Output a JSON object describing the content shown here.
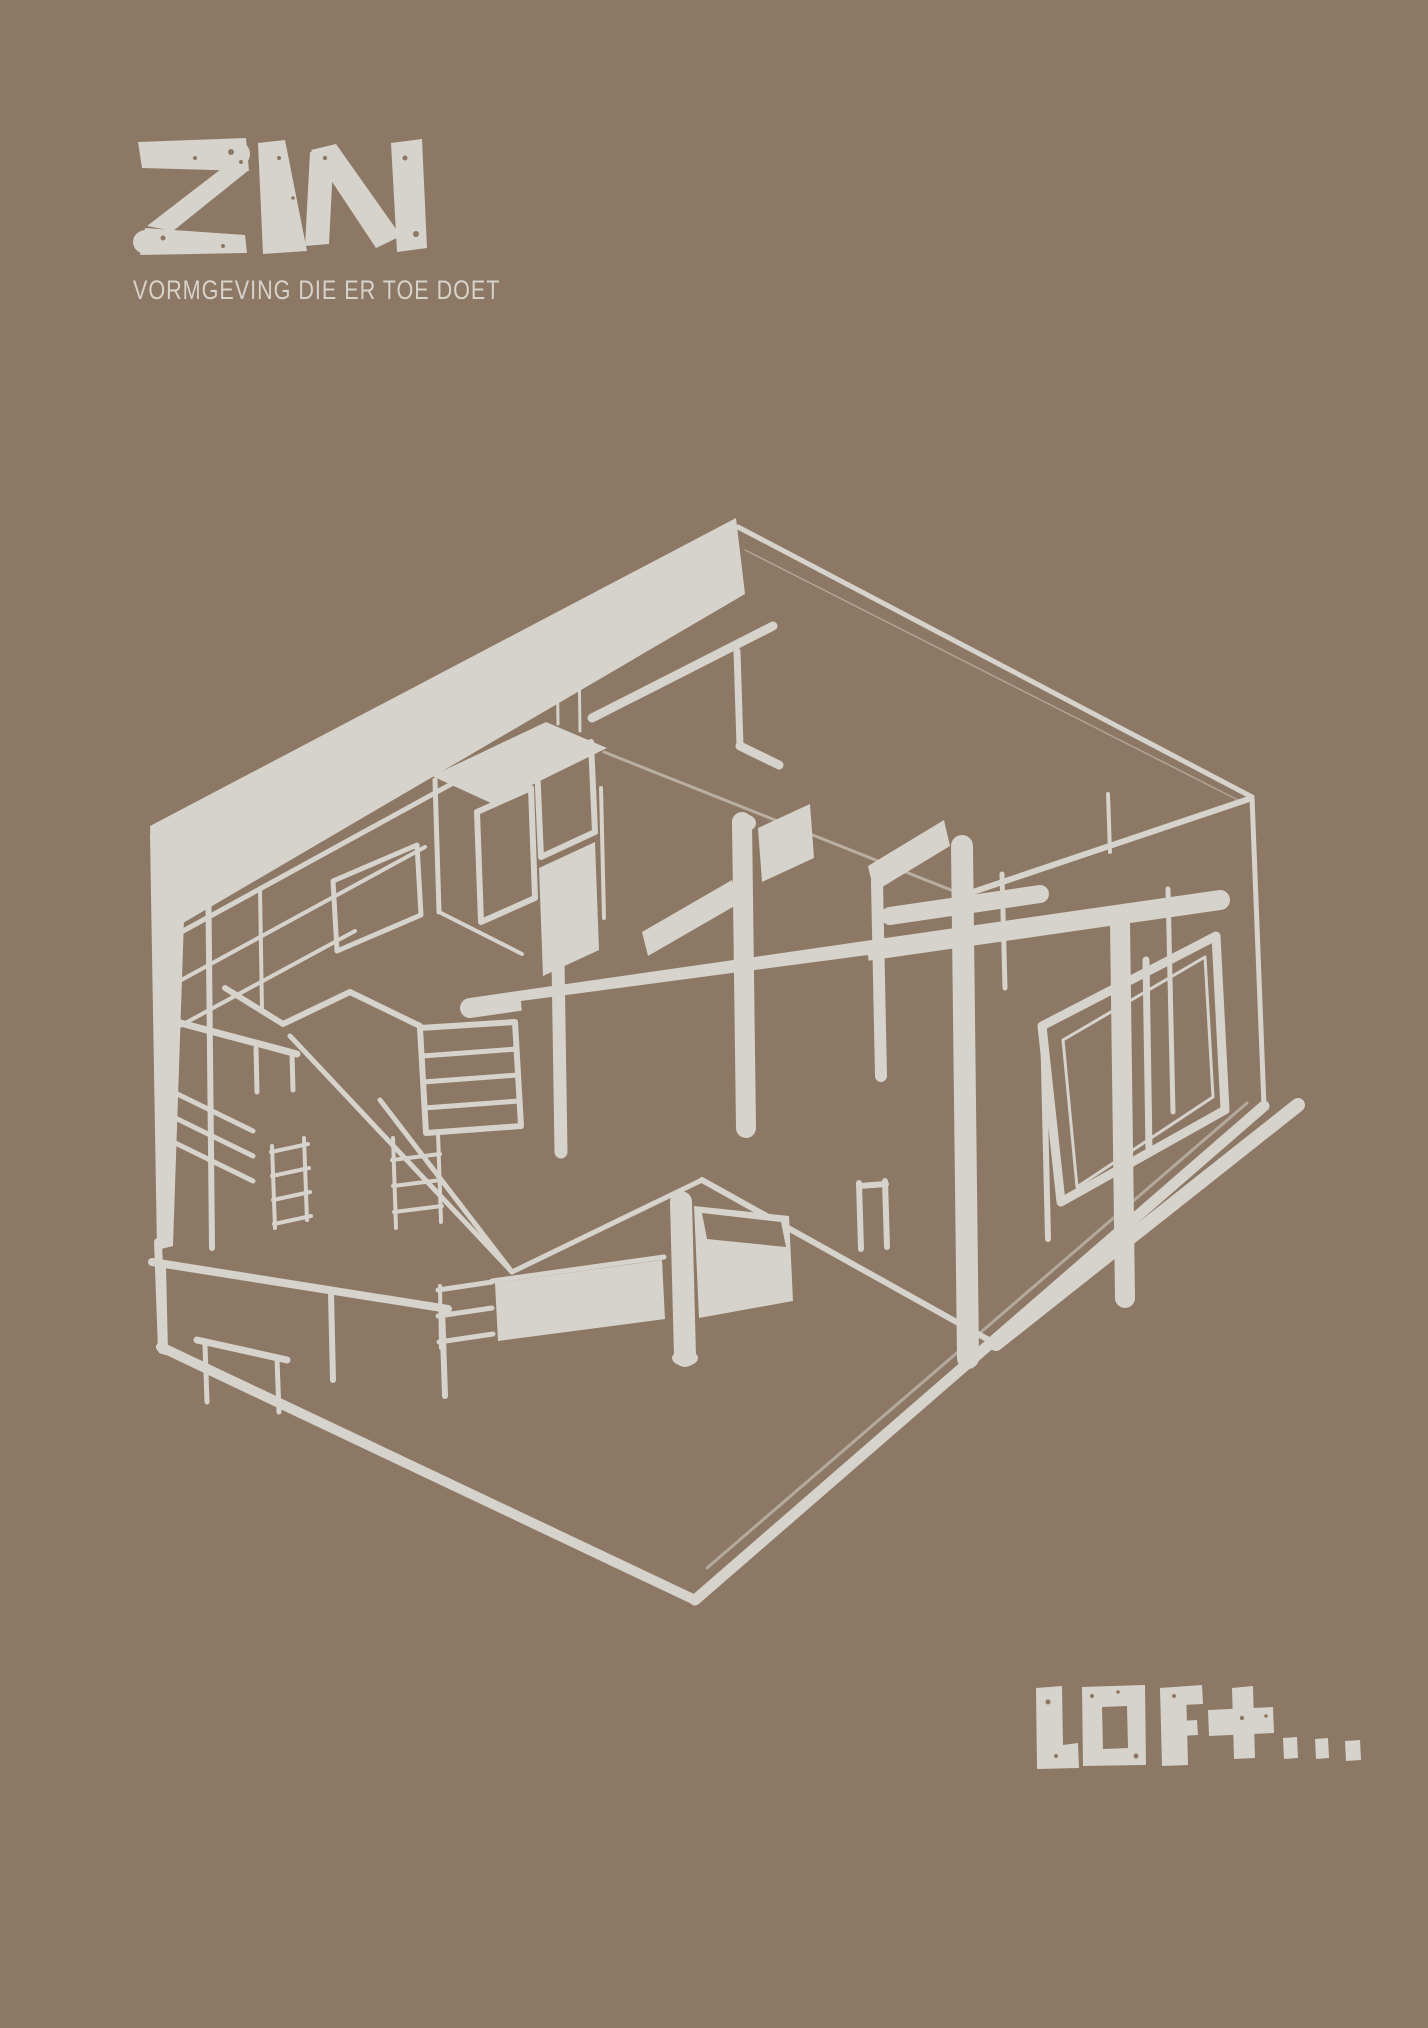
{
  "colors": {
    "background": "#8c7864",
    "ink": "#d6d2cc"
  },
  "brand": {
    "logo_text": "ZIN",
    "tagline": "VORMGEVING DIE ER TOE DOET"
  },
  "illustration": {
    "alt": "Hand-drawn axonometric cutaway sketch of a loft interior inside a hexagonal outline"
  },
  "wordmark": {
    "text": "LOFt..."
  }
}
